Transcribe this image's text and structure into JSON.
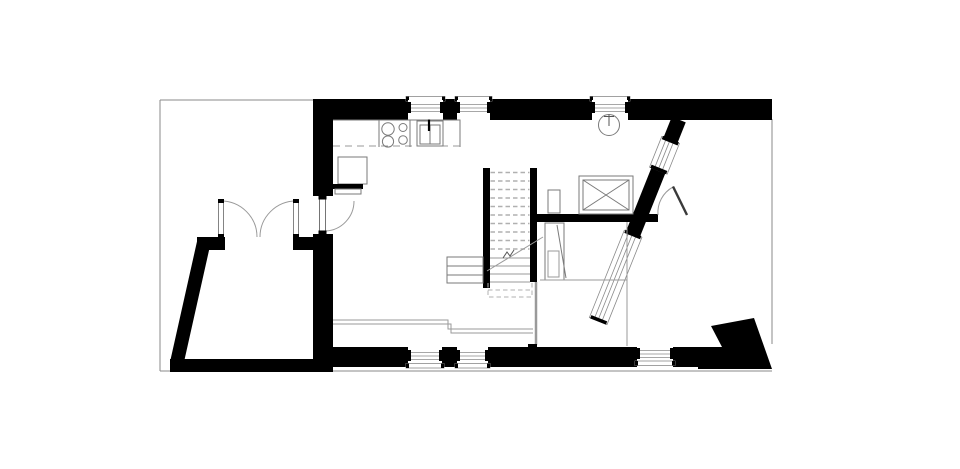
{
  "document": {
    "kind": "architectural-floor-plan",
    "storey": "ground-floor",
    "style": "black-and-white line drawing",
    "visible_text": ""
  },
  "colors": {
    "background": "#ffffff",
    "walls": "#000000",
    "fixture_line": "#7a7a7a",
    "light_line": "#8a8a8a",
    "dash_line": "#b0b0b0",
    "door_leaf": "#3a3a3a"
  },
  "plan_features": {
    "site_boundary": "thin gray outline around plot",
    "shed": "annex with slanted left wall and outward-swinging double doors",
    "kitchen": [
      "counter-with-dashed-front",
      "stove-four-burners",
      "double-bowl-sink",
      "refrigerator",
      "radiator-shelf"
    ],
    "staircase": {
      "dashed_treads": 10,
      "solid_treads": 4,
      "side_steps": 3,
      "direction_line": "with break symbol"
    },
    "fixtures": [
      "skylight-x-box",
      "boiler-circle",
      "duct",
      "wardrobe-with-open-door"
    ],
    "windows": {
      "top_wall": 3,
      "bottom_wall": 3,
      "angled_facade": 2
    },
    "doors": {
      "shed_double_door": 1,
      "entry_door": 1,
      "interior_door": 1
    }
  }
}
